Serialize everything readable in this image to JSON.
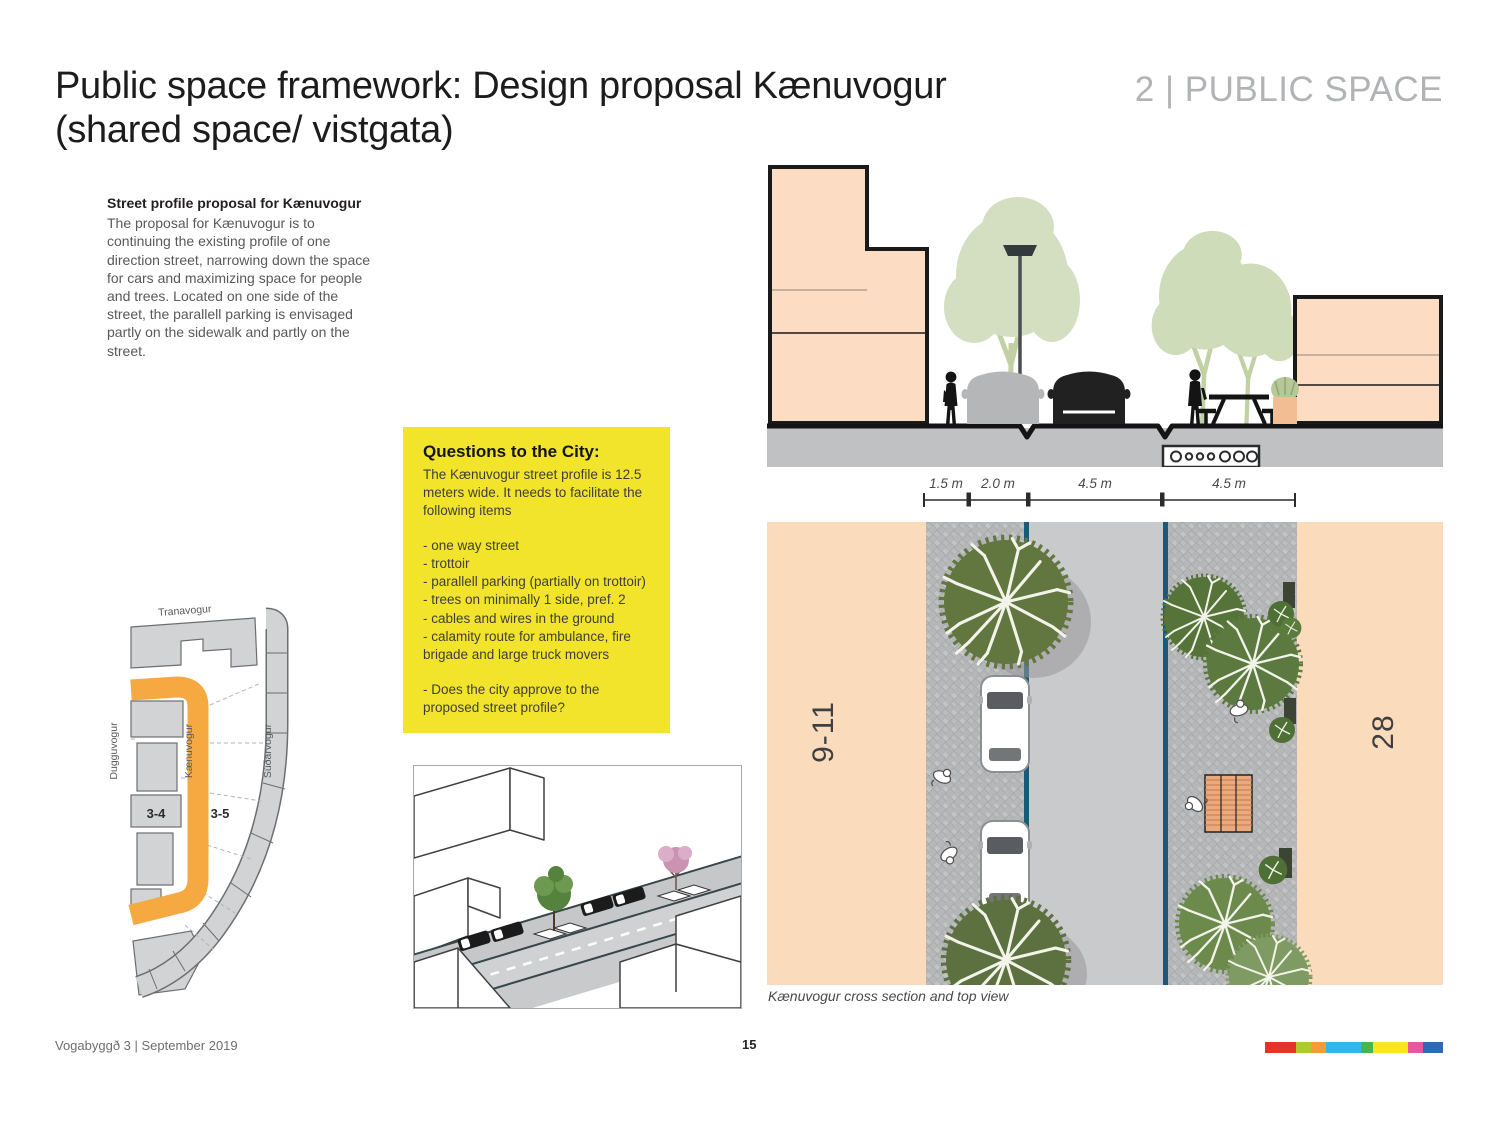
{
  "page": {
    "title_line1": "Public space framework: Design proposal Kænuvogur",
    "title_line2": "(shared space/ vistgata)",
    "section_label": "2 | PUBLIC SPACE",
    "footer_left": "Vogabyggð 3 | September 2019",
    "page_number": "15"
  },
  "intro": {
    "heading": "Street profile proposal for Kænuvogur",
    "body": "The proposal for Kænuvogur is to continuing the existing profile of one direction street, narrowing down the space for cars and maximizing space for people and trees. Located on one side of the street, the parallell parking is envisaged partly on the sidewalk and partly on the street."
  },
  "questions_box": {
    "heading": "Questions to the City:",
    "intro": "The Kænuvogur street profile is 12.5 meters wide. It needs to facilitate the following items",
    "items": [
      "- one way street",
      "- trottoir",
      "- parallell parking (partially on trottoir)",
      "- trees on minimally 1 side, pref. 2",
      "- cables and wires in the ground",
      "- calamity route for ambulance, fire brigade and large truck movers"
    ],
    "question": "- Does the city approve to the proposed street profile?",
    "background_color": "#F2E32B"
  },
  "location_map": {
    "street_top": "Tranavogur",
    "street_left": "Dugguvogur",
    "street_center": "Kænuvogur",
    "street_right": "Súðarvogur",
    "block_left": "3-4",
    "block_right": "3-5",
    "highlight_color": "#F7A941"
  },
  "street_profile": {
    "total_width_m": 12.5,
    "dimension_labels": [
      "1.5 m",
      "2.0 m",
      "4.5 m",
      "4.5 m"
    ],
    "left_building_label": "9-11",
    "right_building_label": "28",
    "caption": "Kænuvogur cross section and top view"
  },
  "brand_bar": {
    "segments": [
      {
        "color": "#E6332A",
        "width": 31
      },
      {
        "color": "#AFCA2C",
        "width": 15
      },
      {
        "color": "#F39C38",
        "width": 15
      },
      {
        "color": "#31B7E8",
        "width": 35
      },
      {
        "color": "#46B450",
        "width": 12
      },
      {
        "color": "#FBE51F",
        "width": 35
      },
      {
        "color": "#E8569D",
        "width": 15
      },
      {
        "color": "#2A6BB4",
        "width": 20
      }
    ]
  }
}
